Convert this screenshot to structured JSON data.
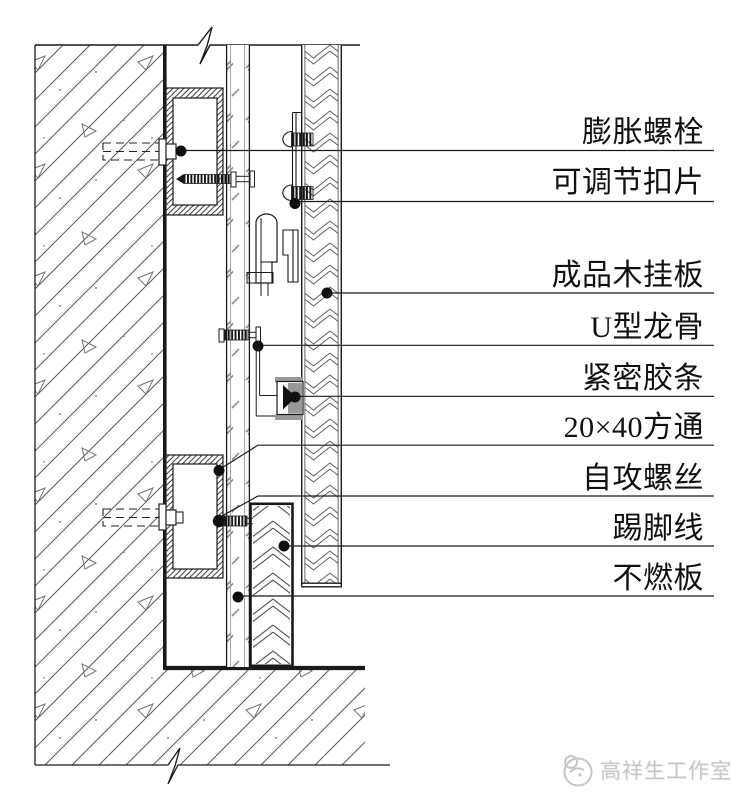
{
  "page": {
    "background": "#ffffff"
  },
  "drawing": {
    "type": "construction-detail-section",
    "labels": [
      {
        "id": "expansion-bolt",
        "text": "膨胀螺栓"
      },
      {
        "id": "adjustable-clip",
        "text": "可调节扣片"
      },
      {
        "id": "finished-wood-panel",
        "text": "成品木挂板"
      },
      {
        "id": "u-channel-keel",
        "text": "U型龙骨"
      },
      {
        "id": "rubber-seal-strip",
        "text": "紧密胶条"
      },
      {
        "id": "square-tube-20x40",
        "text": "20×40方通"
      },
      {
        "id": "self-tapping-screw",
        "text": "自攻螺丝"
      },
      {
        "id": "skirting-line",
        "text": "踢脚线"
      },
      {
        "id": "fireproof-board",
        "text": "不燃板"
      }
    ],
    "colors": {
      "line": "#1a1a1a",
      "seal_gray": "#999999",
      "seal_black": "#111111",
      "watermark": "#c7c7c7"
    }
  },
  "watermark": {
    "studio_name": "高祥生工作室"
  }
}
